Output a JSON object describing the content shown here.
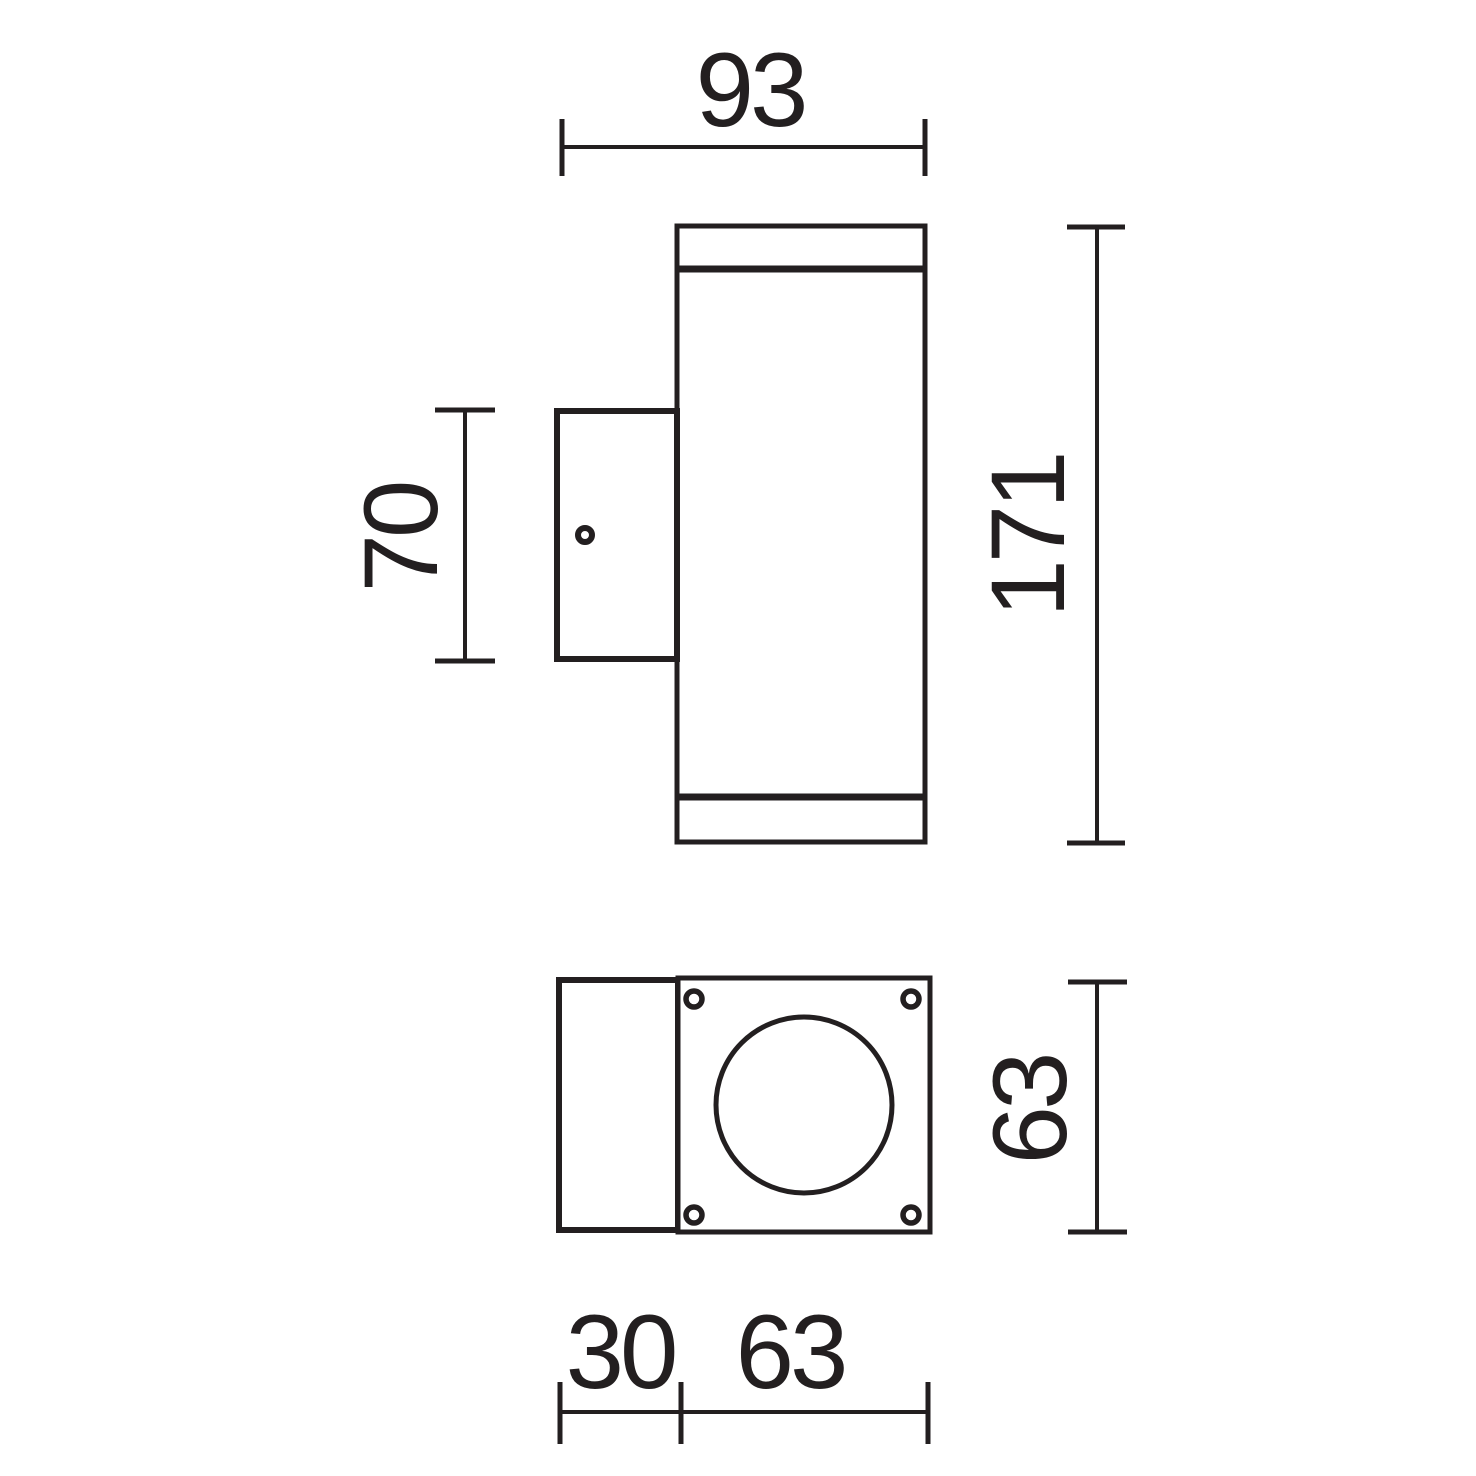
{
  "drawing": {
    "background_color": "#ffffff",
    "line_color": "#231f20"
  },
  "dimensions": {
    "side_view": {
      "overall_width": "93",
      "overall_height": "171",
      "bracket_height": "70"
    },
    "bottom_view": {
      "base_height": "63",
      "bracket_depth": "30",
      "base_width": "63"
    }
  }
}
